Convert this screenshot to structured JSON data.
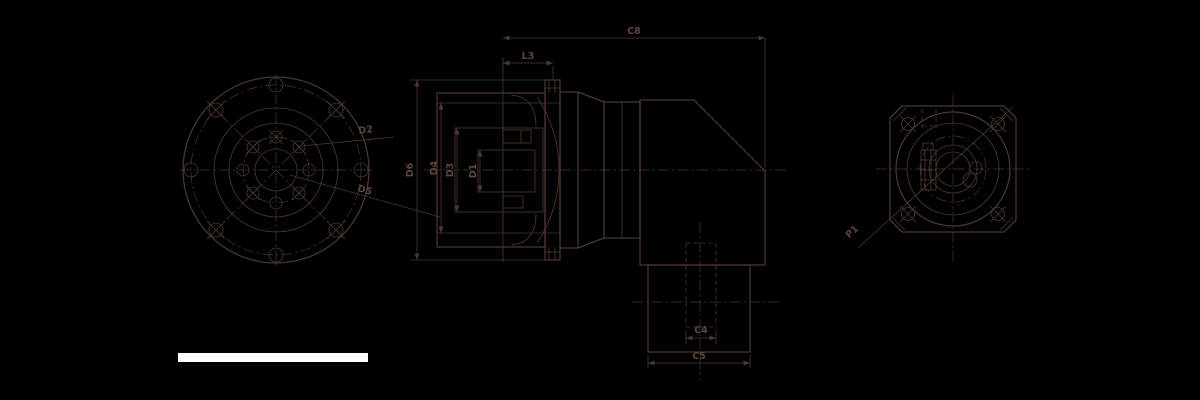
{
  "colors": {
    "bg": "#000000",
    "line": "#4b3731",
    "text": "#5e453d",
    "redaction": "#ffffff"
  },
  "views": {
    "front": {
      "labels": {
        "inner_bolt_circle": "D2",
        "outer_bolt_circle": "D5"
      }
    },
    "side": {
      "labels": {
        "overall_length": "C8",
        "input_section_length": "L3",
        "flange_diameter": "D6",
        "body_diameter": "D4",
        "cavity_diameter": "D3",
        "bore_diameter": "D1",
        "output_boss_width": "C4",
        "output_housing_width": "C5"
      }
    },
    "rear": {
      "labels": {
        "mounting_hole_pitch": "P1"
      }
    }
  }
}
